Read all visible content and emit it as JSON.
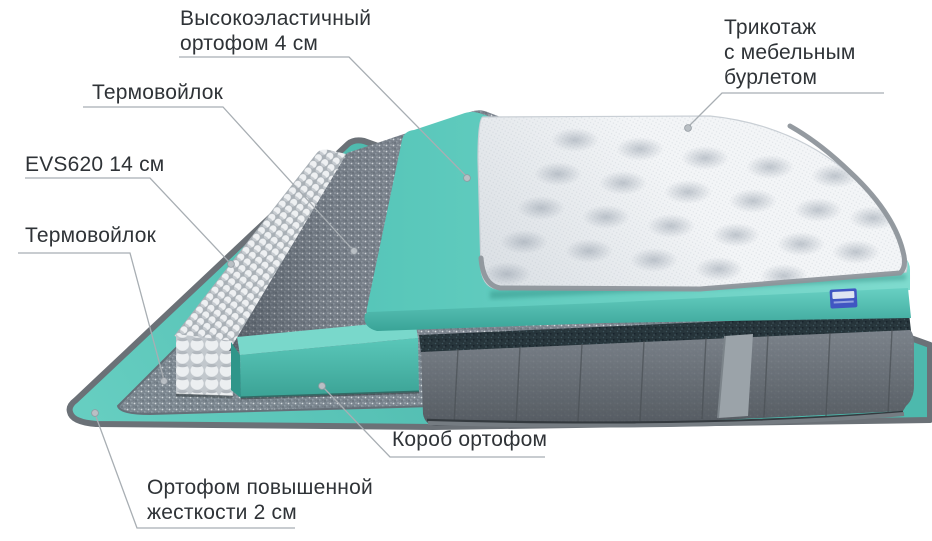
{
  "page": {
    "background": "#ffffff",
    "description": "Схема слоёв матраса"
  },
  "labels": {
    "elastic_foam": {
      "lines": [
        "Высокоэластичный",
        "ортофом 4 см"
      ]
    },
    "knit_cover": {
      "lines": [
        "Трикотаж",
        "с мебельным",
        "бурлетом"
      ]
    },
    "thermofelt_top": {
      "lines": [
        "Термовойлок"
      ]
    },
    "spring_block": {
      "lines": [
        "EVS620 14 см"
      ]
    },
    "thermofelt_bottom": {
      "lines": [
        "Термовойлок"
      ]
    },
    "foam_box": {
      "lines": [
        "Короб ортофом"
      ]
    },
    "rigid_foam": {
      "lines": [
        "Ортофом повышенной",
        "жесткости 2 см"
      ]
    }
  },
  "colors": {
    "foam_teal": "#5fc8bb",
    "foam_teal_light": "#7fdbce",
    "foam_teal_dark": "#3aa094",
    "felt_gray": "#7d858f",
    "velvet_gray": "#6e757c",
    "velvet_dark_piping": "#26343a",
    "quilt_white": "#f3f5f7",
    "piping_gray": "#8e959b",
    "tag_blue": "#4056c2",
    "leader_line_gray": "#a8aeb3",
    "text_dark": "#2f3337",
    "background": "#ffffff"
  }
}
